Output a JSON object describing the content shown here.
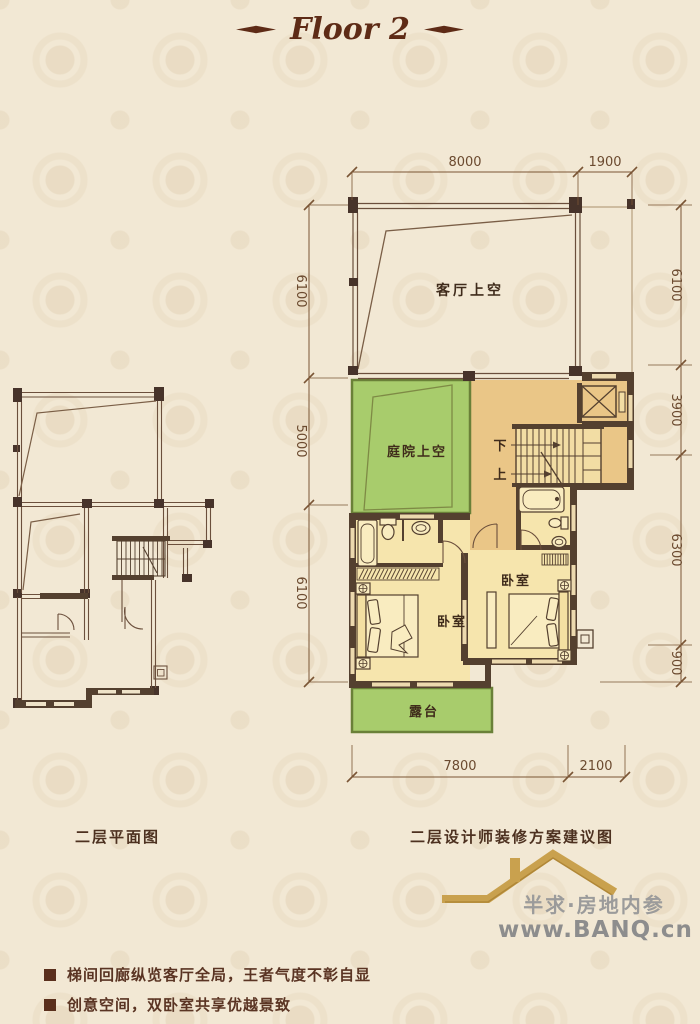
{
  "title": {
    "text": "Floor 2"
  },
  "captions": {
    "left": "二层平面图",
    "right": "二层设计师装修方案建议图"
  },
  "room_labels": {
    "living_void": "客厅上空",
    "courtyard_void": "庭院上空",
    "bedroom_left": "卧室",
    "bedroom_right": "卧室",
    "terrace": "露台",
    "stairs_down": "下",
    "stairs_up": "上"
  },
  "dimensions": {
    "top": [
      "8000",
      "1900"
    ],
    "right": [
      "6100",
      "3900",
      "6300",
      "900"
    ],
    "inner_left": [
      "6100",
      "5000",
      "6100"
    ],
    "bottom": [
      "7800",
      "2100"
    ]
  },
  "notes": [
    "梯间回廊纵览客厅全局，王者气度不彰自显",
    "创意空间，双卧室共享优越景致"
  ],
  "logo": {
    "brand": "半求·房地内参",
    "website": "www.BANQ.cn"
  },
  "colors": {
    "background": "#f2e8d4",
    "wall_dark": "#54402f",
    "floor_tan": "#eac687",
    "floor_yellow": "#f6e5ad",
    "green": "#a8cc6c",
    "title_brown": "#5e2b16",
    "logo_gold": "#c9a14e",
    "logo_gray": "#9b9b9b",
    "dimension_brown": "#6b4a2f"
  }
}
